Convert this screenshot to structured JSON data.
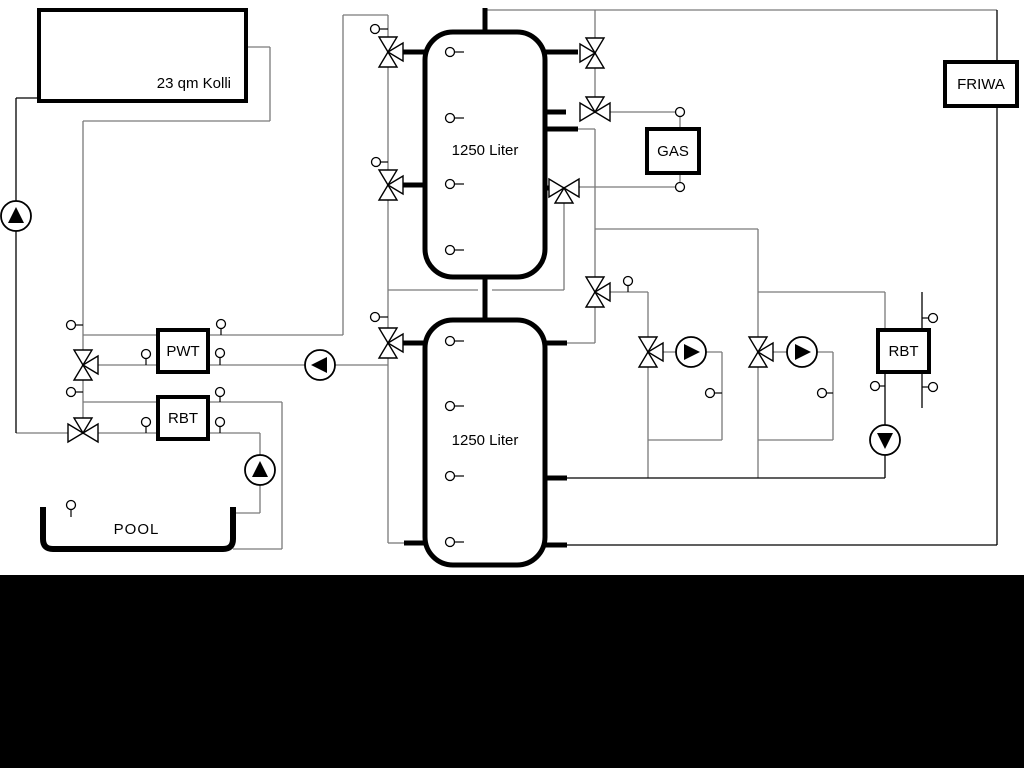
{
  "page": {
    "background": "#ffffff",
    "bottom_bar_color": "#000000",
    "line_color_gray": "#7a7a7a",
    "line_color_black": "#000000"
  },
  "labels": {
    "collector": "23 qm Kolli",
    "tank_top": "1250 Liter",
    "tank_bottom": "1250 Liter",
    "gas": "GAS",
    "friwa": "FRIWA",
    "pwt": "PWT",
    "rbt_left": "RBT",
    "rbt_right": "RBT",
    "pool": "POOL"
  },
  "components": {
    "pumps": 6,
    "three_way_valves": 11,
    "temperature_sensors": 30,
    "storage_tanks": 2
  }
}
